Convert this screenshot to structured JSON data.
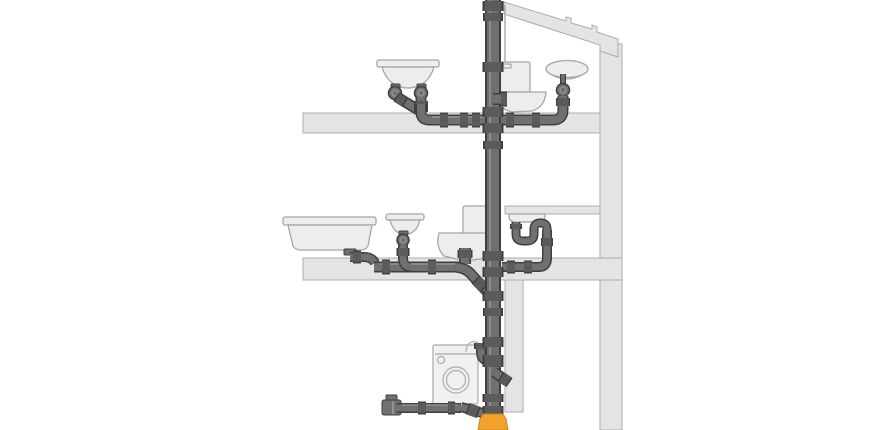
{
  "diagram": {
    "type": "plumbing-drainage-cross-section",
    "subject": "building waste-water drainage system with main soil stack",
    "colors": {
      "background": "#ffffff",
      "structure": "#e4e4e4",
      "structure_outline": "#adadad",
      "fixture": "#ededed",
      "fixture_outline": "#a5a5a5",
      "ghost": "#f1f1f1",
      "ghost_outline": "#b5b5b5",
      "pipe_outline": "#3f3f3f",
      "pipe_body": "#707070",
      "coupling": "#5b5b5b",
      "pipe_highlight": "#9e9e9e",
      "underground_fitting": "#f2a12a",
      "underground_outline": "#c9841a"
    },
    "floors": [
      {
        "name": "top-floor",
        "fixtures": [
          "double-washbasin",
          "toilet",
          "washbasin"
        ]
      },
      {
        "name": "middle-floor",
        "fixtures": [
          "bathtub",
          "washbasin",
          "toilet",
          "kitchen-sink"
        ]
      },
      {
        "name": "ground-level",
        "fixtures": [
          "washing-machine"
        ]
      }
    ],
    "pipes": [
      "main-soil-stack",
      "top-floor-branch",
      "middle-floor-branch",
      "kitchen-sink-branch",
      "washing-machine-standpipe",
      "basement-branch",
      "underground-adapter"
    ]
  }
}
